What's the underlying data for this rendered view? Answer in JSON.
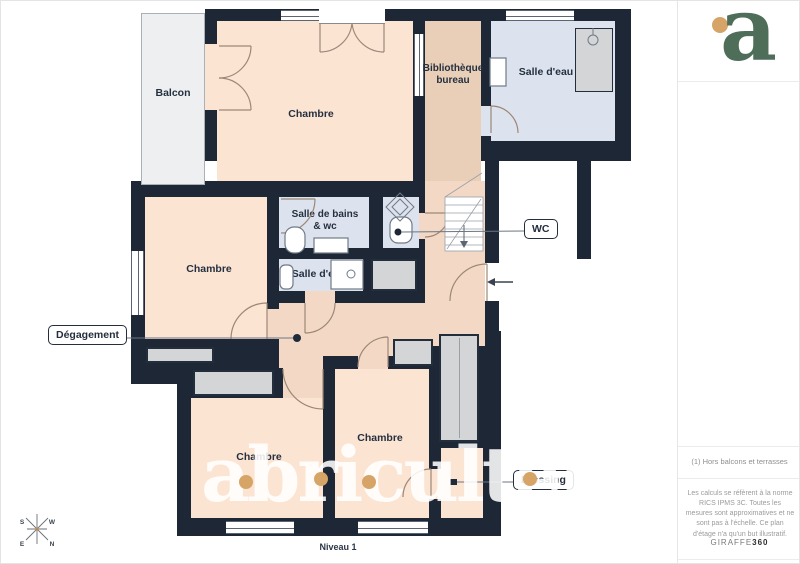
{
  "page": {
    "level_label": "Niveau 1"
  },
  "brand": {
    "watermark_text": "abriculteurs",
    "logo_letter": "a"
  },
  "plan": {
    "rooms": {
      "balcon": {
        "label": "Balcon"
      },
      "chambre_top": {
        "label": "Chambre"
      },
      "bibliotheque": {
        "label_line1": "Bibliothèque",
        "label_line2": "bureau"
      },
      "salle_eau_top": {
        "label": "Salle d'eau"
      },
      "salle_de_bains": {
        "label_line1": "Salle de bains",
        "label_line2": "& wc"
      },
      "salle_eau_mid": {
        "label": "Salle d'eau"
      },
      "chambre_left": {
        "label": "Chambre"
      },
      "chambre_bottom_left": {
        "label": "Chambre"
      },
      "chambre_bottom_mid": {
        "label": "Chambre"
      }
    },
    "callouts": {
      "degagement": "Dégagement",
      "wc": "WC",
      "dressing": "Dressing"
    },
    "compass": {
      "s": "S",
      "w": "W",
      "e": "E",
      "n": "N"
    }
  },
  "sidebar": {
    "note": "(1) Hors balcons et terrasses",
    "disclaimer": "Les calculs se réfèrent à la norme RICS IPMS 3C. Toutes les mesures sont approximatives et ne sont pas à l'échelle. Ce plan d'étage n'a qu'un but illustratif.",
    "provider": "GIRAFFE",
    "provider_suffix": "360"
  },
  "colors": {
    "wall": "#1e2735",
    "bedroom": "#fce4d3",
    "hallway": "#f3d9c5",
    "library": "#e9cfb8",
    "bathroom": "#dde3ee",
    "balcony": "#edeff1",
    "closet": "#d3d5d7",
    "watermark_dot": "#d6a466",
    "brand_green": "#4f6e5a",
    "brand_orange": "#d6a466"
  }
}
